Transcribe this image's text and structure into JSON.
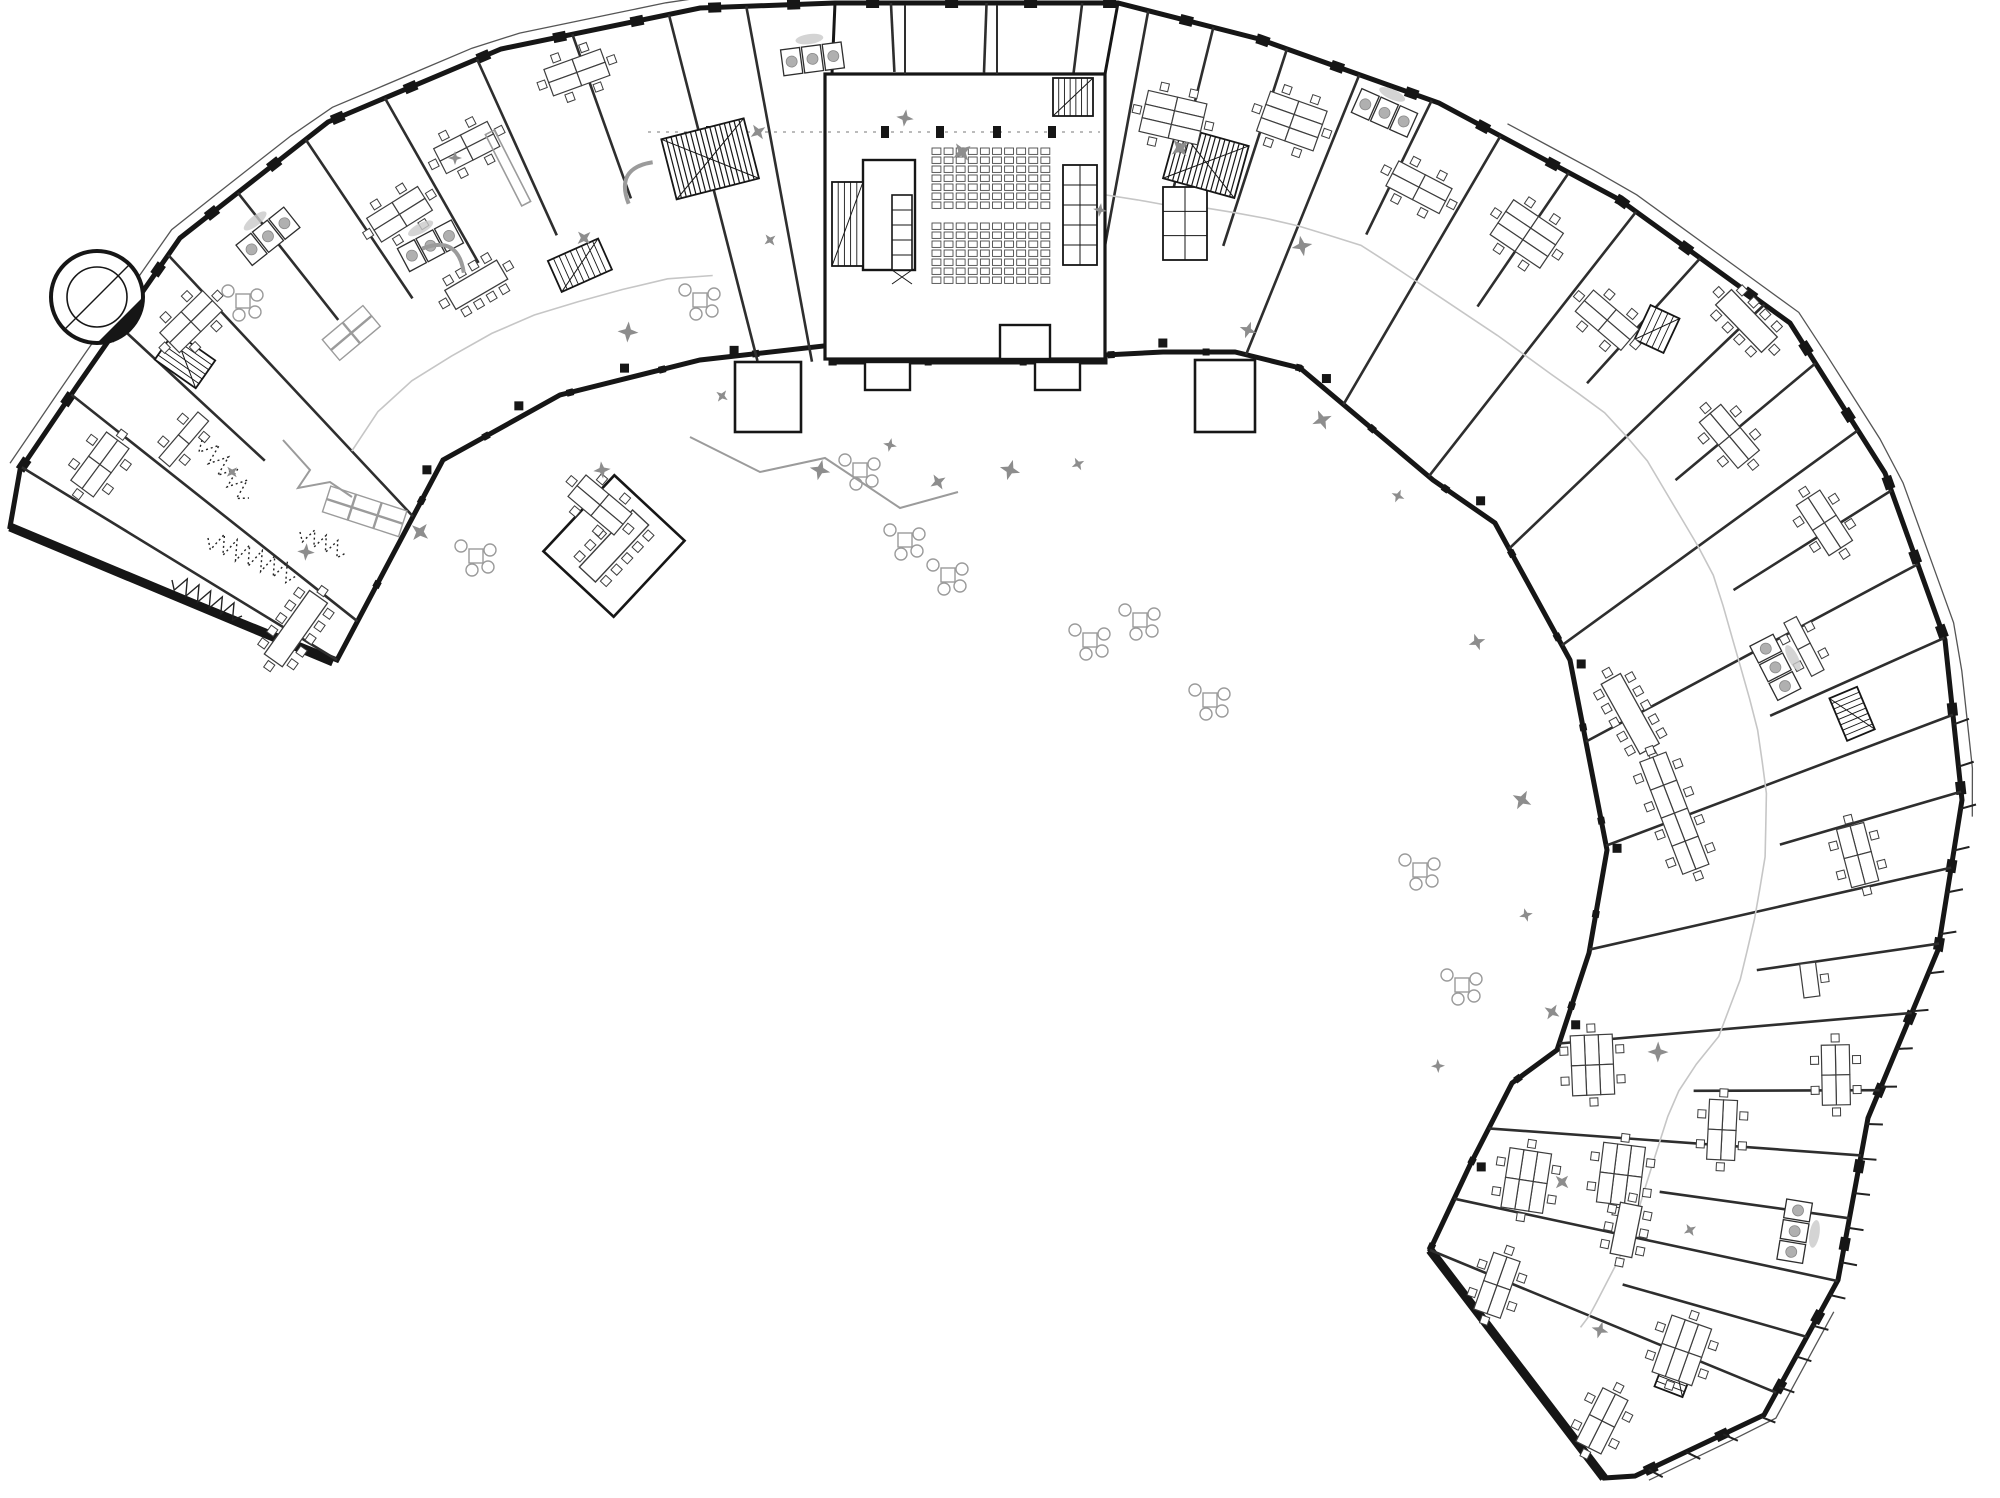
{
  "canvas": {
    "w": 2000,
    "h": 1498,
    "bg": "#ffffff"
  },
  "palette": {
    "wall": "#161616",
    "wall_soft": "#2e2e2e",
    "furn": "#3d3d3d",
    "gray": "#9b9b9b",
    "light": "#b8b8b8",
    "corridor": "#c6c6c6",
    "accent": "#8d8d8d",
    "white": "#ffffff"
  },
  "center": {
    "x": 948,
    "y": 1092
  },
  "boundary": {
    "outer": [
      [
        20,
        470
      ],
      [
        77,
        386
      ],
      [
        180,
        238
      ],
      [
        328,
        122
      ],
      [
        501,
        49
      ],
      [
        700,
        8
      ],
      [
        835,
        3
      ],
      [
        1118,
        3
      ],
      [
        1259,
        39
      ],
      [
        1439,
        103
      ],
      [
        1620,
        200
      ],
      [
        1790,
        323
      ],
      [
        1885,
        473
      ],
      [
        1945,
        640
      ],
      [
        1962,
        800
      ],
      [
        1938,
        950
      ],
      [
        1868,
        1118
      ],
      [
        1838,
        1280
      ],
      [
        1764,
        1415
      ],
      [
        1635,
        1476
      ],
      [
        1604,
        1478
      ]
    ],
    "inner": [
      [
        1430,
        1250
      ],
      [
        1470,
        1165
      ],
      [
        1512,
        1083
      ],
      [
        1557,
        1050
      ],
      [
        1589,
        953
      ],
      [
        1607,
        850
      ],
      [
        1570,
        660
      ],
      [
        1495,
        523
      ],
      [
        1433,
        480
      ],
      [
        1300,
        368
      ],
      [
        1235,
        352
      ],
      [
        1163,
        352
      ],
      [
        1105,
        355
      ],
      [
        1105,
        362
      ],
      [
        832,
        362
      ],
      [
        832,
        345
      ],
      [
        700,
        360
      ],
      [
        560,
        395
      ],
      [
        443,
        460
      ],
      [
        390,
        560
      ],
      [
        337,
        660
      ]
    ],
    "tail": [
      [
        10,
        527
      ],
      [
        20,
        470
      ]
    ],
    "thick_edges": [
      [
        [
          10,
          527
        ],
        [
          333,
          662
        ]
      ],
      [
        [
          1604,
          1478
        ],
        [
          1430,
          1250
        ]
      ]
    ]
  },
  "block": {
    "x": 825,
    "y": 74,
    "w": 280,
    "h": 285,
    "top_walls": [
      [
        835,
        3,
        832,
        74
      ],
      [
        1118,
        3,
        1105,
        74
      ]
    ],
    "top_dividers": [
      [
        905,
        5,
        905,
        74
      ],
      [
        997,
        5,
        997,
        74
      ]
    ],
    "vestibules": [
      [
        863,
        160,
        52,
        110
      ],
      [
        1000,
        325,
        50,
        34
      ],
      [
        865,
        362,
        45,
        28
      ],
      [
        1035,
        362,
        45,
        28
      ]
    ],
    "dash_line": {
      "x1": 648,
      "y1": 132,
      "x2": 1100,
      "y2": 132
    },
    "ticks": [
      [
        885,
        126
      ],
      [
        940,
        126
      ],
      [
        997,
        126
      ],
      [
        1052,
        126
      ],
      [
        710,
        126
      ]
    ]
  },
  "seats": [
    {
      "x": 932,
      "y": 148,
      "cols": 10,
      "rows": 7,
      "pw": 12.1,
      "ph": 9
    },
    {
      "x": 932,
      "y": 223,
      "cols": 10,
      "rows": 7,
      "pw": 12.1,
      "ph": 9
    }
  ],
  "skylights": [
    {
      "x": 1063,
      "y": 165,
      "w": 34,
      "h": 100,
      "cols": 2,
      "rows": 5
    },
    {
      "x": 1163,
      "y": 187,
      "w": 44,
      "h": 73,
      "cols": 2,
      "rows": 3
    }
  ],
  "kitchen": {
    "x": 892,
    "y": 195,
    "w": 20,
    "h": 75,
    "units": 4
  },
  "partitions": [
    [
      -146,
      0,
      1
    ],
    [
      -141.5,
      0,
      1
    ],
    [
      -137.3,
      0.45,
      1
    ],
    [
      -133,
      0,
      1
    ],
    [
      -128.3,
      0.52,
      1
    ],
    [
      -124,
      0.45,
      1
    ],
    [
      -119.5,
      0.45,
      1
    ],
    [
      -114.5,
      0.45,
      1
    ],
    [
      -109.5,
      0.5,
      1
    ],
    [
      -104.5,
      0,
      1
    ],
    [
      -100.5,
      0,
      1
    ],
    [
      -93,
      0.8,
      1
    ],
    [
      -88,
      0.8,
      1
    ],
    [
      -83,
      0.8,
      1
    ],
    [
      -79.5,
      0,
      1
    ],
    [
      -76,
      0.45,
      1
    ],
    [
      -72,
      0.35,
      1
    ],
    [
      -68,
      0,
      1
    ],
    [
      -64,
      0.5,
      1
    ],
    [
      -60,
      0,
      1
    ],
    [
      -56,
      0.5,
      1
    ],
    [
      -52,
      0,
      1
    ],
    [
      -48,
      0.5,
      1
    ],
    [
      -44,
      0,
      1
    ],
    [
      -40,
      0.5,
      1
    ],
    [
      -36,
      0,
      1
    ],
    [
      -32.5,
      0.5,
      1
    ],
    [
      -28.5,
      0,
      1
    ],
    [
      -24.5,
      0.5,
      1
    ],
    [
      -20.5,
      0,
      1
    ],
    [
      -16.5,
      0.5,
      1
    ],
    [
      -12.5,
      0,
      1
    ],
    [
      -8.5,
      0.5,
      1
    ],
    [
      -4.5,
      0,
      1
    ],
    [
      0,
      0.5,
      1
    ],
    [
      4,
      0,
      1
    ],
    [
      8,
      0.5,
      1
    ],
    [
      12,
      0,
      1
    ],
    [
      16,
      0.5,
      1
    ],
    [
      20,
      0,
      1
    ]
  ],
  "corridors": [
    {
      "a1": -80,
      "a2": 22,
      "f": 0.46,
      "step": 2
    },
    {
      "a1": -133,
      "a2": -104,
      "f": 0.25,
      "step": 3
    }
  ],
  "columns": {
    "angles": [
      -130,
      -122,
      -114,
      -106,
      -90,
      -74,
      -62,
      -48,
      -34,
      -20,
      -6,
      8
    ],
    "f": 0.03,
    "size": 9
  },
  "stairs": [
    {
      "a": -74.5,
      "r": 965,
      "w": 74,
      "h": 54,
      "big": true
    },
    {
      "a": -104.3,
      "r": 963,
      "w": 85,
      "h": 62,
      "big": true
    },
    {
      "x": 1053,
      "y": 78,
      "w": 40,
      "h": 38,
      "rot": 0,
      "big": false
    },
    {
      "x": 832,
      "y": 182,
      "w": 31,
      "h": 84,
      "rot": 0,
      "big": false
    },
    {
      "a": -114,
      "r": 905,
      "w": 55,
      "h": 34,
      "big": false
    },
    {
      "a": -22.7,
      "r": 980,
      "w": 46,
      "h": 30,
      "big": false
    },
    {
      "a": 20.9,
      "r": 780,
      "w": 46,
      "h": 30,
      "big": false
    },
    {
      "x": 168,
      "y": 335,
      "w": 34,
      "h": 50,
      "rot": -55,
      "big": false
    },
    {
      "x": 1641,
      "y": 310,
      "w": 32,
      "h": 38,
      "rot": 25,
      "big": false
    }
  ],
  "annexes": {
    "left_stair": {
      "x": 735,
      "y": 362,
      "w": 66,
      "h": 70
    },
    "right_stair": {
      "x": 1195,
      "y": 360,
      "w": 60,
      "h": 72
    },
    "meet": {
      "cx": 614,
      "cy": 546,
      "w": 104,
      "h": 96,
      "rot": -47,
      "table_len": 78,
      "table_w": 22
    }
  },
  "clusters": [
    {
      "t": "c4",
      "a": -143.5,
      "r": 1055
    },
    {
      "t": "c2",
      "a": -139.5,
      "r": 1005
    },
    {
      "t": "meet",
      "a": -144.6,
      "r": 800,
      "len": 78
    },
    {
      "t": "c4",
      "a": -134.5,
      "r": 1080
    },
    {
      "t": "c4",
      "a": -122,
      "r": 1035
    },
    {
      "t": "c4",
      "a": -117,
      "r": 1060
    },
    {
      "t": "c4",
      "a": -110,
      "r": 1085
    },
    {
      "t": "meet",
      "a": -120.3,
      "r": 935,
      "len": 60
    },
    {
      "t": "c6",
      "a": -77,
      "r": 1000
    },
    {
      "t": "c6",
      "a": -70.5,
      "r": 1030
    },
    {
      "t": "c4",
      "a": -62.5,
      "r": 1020
    },
    {
      "t": "c6",
      "a": -56,
      "r": 1035
    },
    {
      "t": "c4",
      "a": -49.5,
      "r": 1015
    },
    {
      "t": "meet",
      "a": -44,
      "r": 1110,
      "len": 66
    },
    {
      "t": "c4",
      "a": -40,
      "r": 1020
    },
    {
      "t": "c4",
      "a": -33,
      "r": 1045
    },
    {
      "t": "c2",
      "a": -27.5,
      "r": 965
    },
    {
      "t": "meet",
      "a": -29,
      "r": 780,
      "len": 80
    },
    {
      "t": "row",
      "a": -21,
      "r": 778,
      "len": 116
    },
    {
      "t": "c4",
      "a": -14.6,
      "r": 940
    },
    {
      "t": "one",
      "a": -7.4,
      "r": 869
    },
    {
      "t": "c6",
      "a": -2.4,
      "r": 645
    },
    {
      "t": "c6",
      "a": 8.7,
      "r": 585
    },
    {
      "t": "c4",
      "a": 19.4,
      "r": 582
    },
    {
      "t": "c6",
      "a": 7,
      "r": 678
    },
    {
      "t": "c4",
      "a": 2.8,
      "r": 775
    },
    {
      "t": "c4",
      "a": -1.1,
      "r": 888
    },
    {
      "t": "c6",
      "a": 19.4,
      "r": 778
    },
    {
      "t": "c4",
      "a": 26.7,
      "r": 732
    },
    {
      "t": "meet",
      "a": 11.5,
      "r": 692,
      "len": 52
    },
    {
      "t": "c4",
      "x": 600,
      "y": 505,
      "rot": 40
    }
  ],
  "wcs": [
    {
      "a": -128.5,
      "r": 1093
    },
    {
      "x": 430,
      "y": 246,
      "rot": -28
    },
    {
      "a": -97.5,
      "r": 1042
    },
    {
      "a": -66,
      "r": 1072
    },
    {
      "a": -27.2,
      "r": 930
    },
    {
      "a": 9.3,
      "r": 858
    }
  ],
  "accents": [
    {
      "t": "gt",
      "x": 352,
      "y": 333,
      "rot": -40
    },
    {
      "t": "gc",
      "x": 243,
      "y": 301
    },
    {
      "t": "gs",
      "x": 448,
      "y": 252,
      "rot": 30
    },
    {
      "t": "gs",
      "x": 632,
      "y": 178,
      "rot": -60
    },
    {
      "t": "gb",
      "x": 508,
      "y": 168,
      "rot": 63,
      "len": 80,
      "wd": 10
    },
    {
      "t": "gc",
      "x": 700,
      "y": 300
    },
    {
      "t": "gt3",
      "x": 365,
      "y": 512,
      "rot": 18
    },
    {
      "t": "gc",
      "x": 476,
      "y": 556
    },
    {
      "t": "gc",
      "x": 905,
      "y": 540
    },
    {
      "t": "gc",
      "x": 948,
      "y": 575
    },
    {
      "t": "gc",
      "x": 1090,
      "y": 640
    },
    {
      "t": "gc",
      "x": 1140,
      "y": 620
    },
    {
      "t": "gc",
      "x": 1210,
      "y": 700
    },
    {
      "t": "gc",
      "x": 1420,
      "y": 870
    },
    {
      "t": "gc",
      "x": 1462,
      "y": 985
    },
    {
      "t": "gc",
      "x": 860,
      "y": 470
    },
    {
      "t": "gw",
      "pts": [
        [
          283,
          440
        ],
        [
          310,
          470
        ],
        [
          298,
          488
        ],
        [
          330,
          482
        ],
        [
          352,
          497
        ]
      ]
    },
    {
      "t": "gw",
      "pts": [
        [
          690,
          437
        ],
        [
          760,
          472
        ],
        [
          825,
          458
        ],
        [
          900,
          508
        ],
        [
          958,
          492
        ]
      ]
    }
  ],
  "zigzags": [
    {
      "x1": 202,
      "y1": 440,
      "x2": 249,
      "y2": 498,
      "n": 5,
      "amp": 10,
      "dotted": true
    },
    {
      "x1": 208,
      "y1": 538,
      "x2": 296,
      "y2": 576,
      "n": 7,
      "amp": 10,
      "dotted": true
    },
    {
      "x1": 300,
      "y1": 532,
      "x2": 346,
      "y2": 553,
      "n": 4,
      "amp": 8,
      "dotted": true
    },
    {
      "x1": 172,
      "y1": 580,
      "x2": 242,
      "y2": 616,
      "n": 6,
      "amp": 8,
      "dotted": false
    }
  ],
  "plants": [
    [
      455,
      158
    ],
    [
      584,
      238
    ],
    [
      628,
      332
    ],
    [
      770,
      240
    ],
    [
      905,
      118
    ],
    [
      962,
      152
    ],
    [
      890,
      445
    ],
    [
      938,
      482
    ],
    [
      1010,
      470
    ],
    [
      1078,
      464
    ],
    [
      1248,
      330
    ],
    [
      1322,
      420
    ],
    [
      1398,
      496
    ],
    [
      1477,
      642
    ],
    [
      1522,
      800
    ],
    [
      1526,
      915
    ],
    [
      1552,
      1012
    ],
    [
      1302,
      246
    ],
    [
      722,
      396
    ],
    [
      602,
      470
    ],
    [
      420,
      532
    ],
    [
      1438,
      1066
    ],
    [
      1562,
      1182
    ],
    [
      1658,
      1052
    ],
    [
      232,
      472
    ],
    [
      306,
      552
    ],
    [
      1180,
      148
    ],
    [
      1100,
      210
    ],
    [
      758,
      132
    ],
    [
      820,
      470
    ],
    [
      1690,
      1230
    ],
    [
      1600,
      1330
    ]
  ],
  "tower": {
    "x": 97,
    "y": 297,
    "r1": 46,
    "r2": 30
  },
  "fins": [
    {
      "a1": -147,
      "a2": -96,
      "off": 12
    },
    {
      "a1": -60,
      "a2": -14,
      "off": 14
    },
    {
      "a1": 14,
      "a2": 30,
      "off": 12
    }
  ],
  "fin_ticks": {
    "a1": -20,
    "a2": 30,
    "step": 2.2,
    "len": 16
  }
}
